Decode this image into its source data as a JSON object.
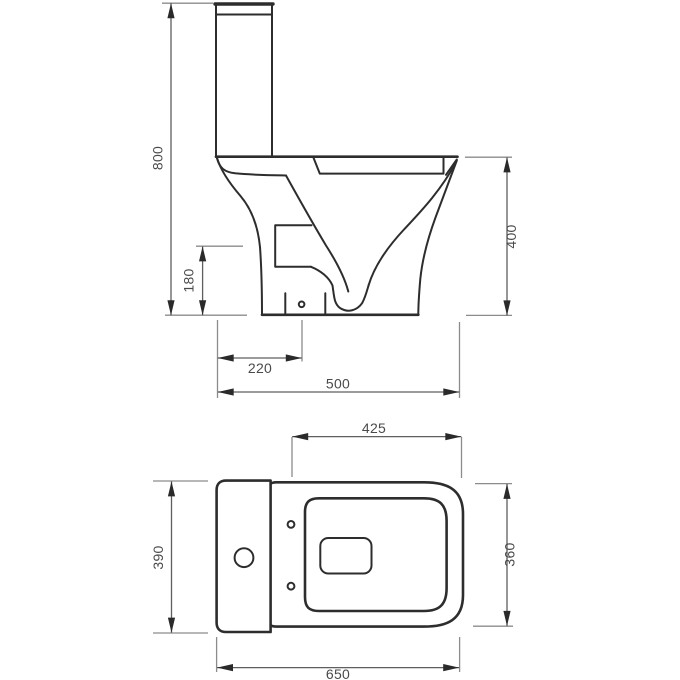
{
  "diagram": {
    "views": {
      "side": {
        "overall_height": "800",
        "trap_height": "180",
        "rim_height": "400",
        "outlet_setout": "220",
        "depth": "500"
      },
      "plan": {
        "seat_length": "425",
        "cistern_width": "390",
        "pan_width": "360",
        "overall_depth": "650"
      }
    },
    "colors": {
      "outline": "#2d2d2d",
      "dim": "#5f5f5f",
      "ext": "#8c8c8c",
      "arrow": "#2a2a2a",
      "label": "#4a4a4a",
      "background": "#ffffff"
    }
  }
}
